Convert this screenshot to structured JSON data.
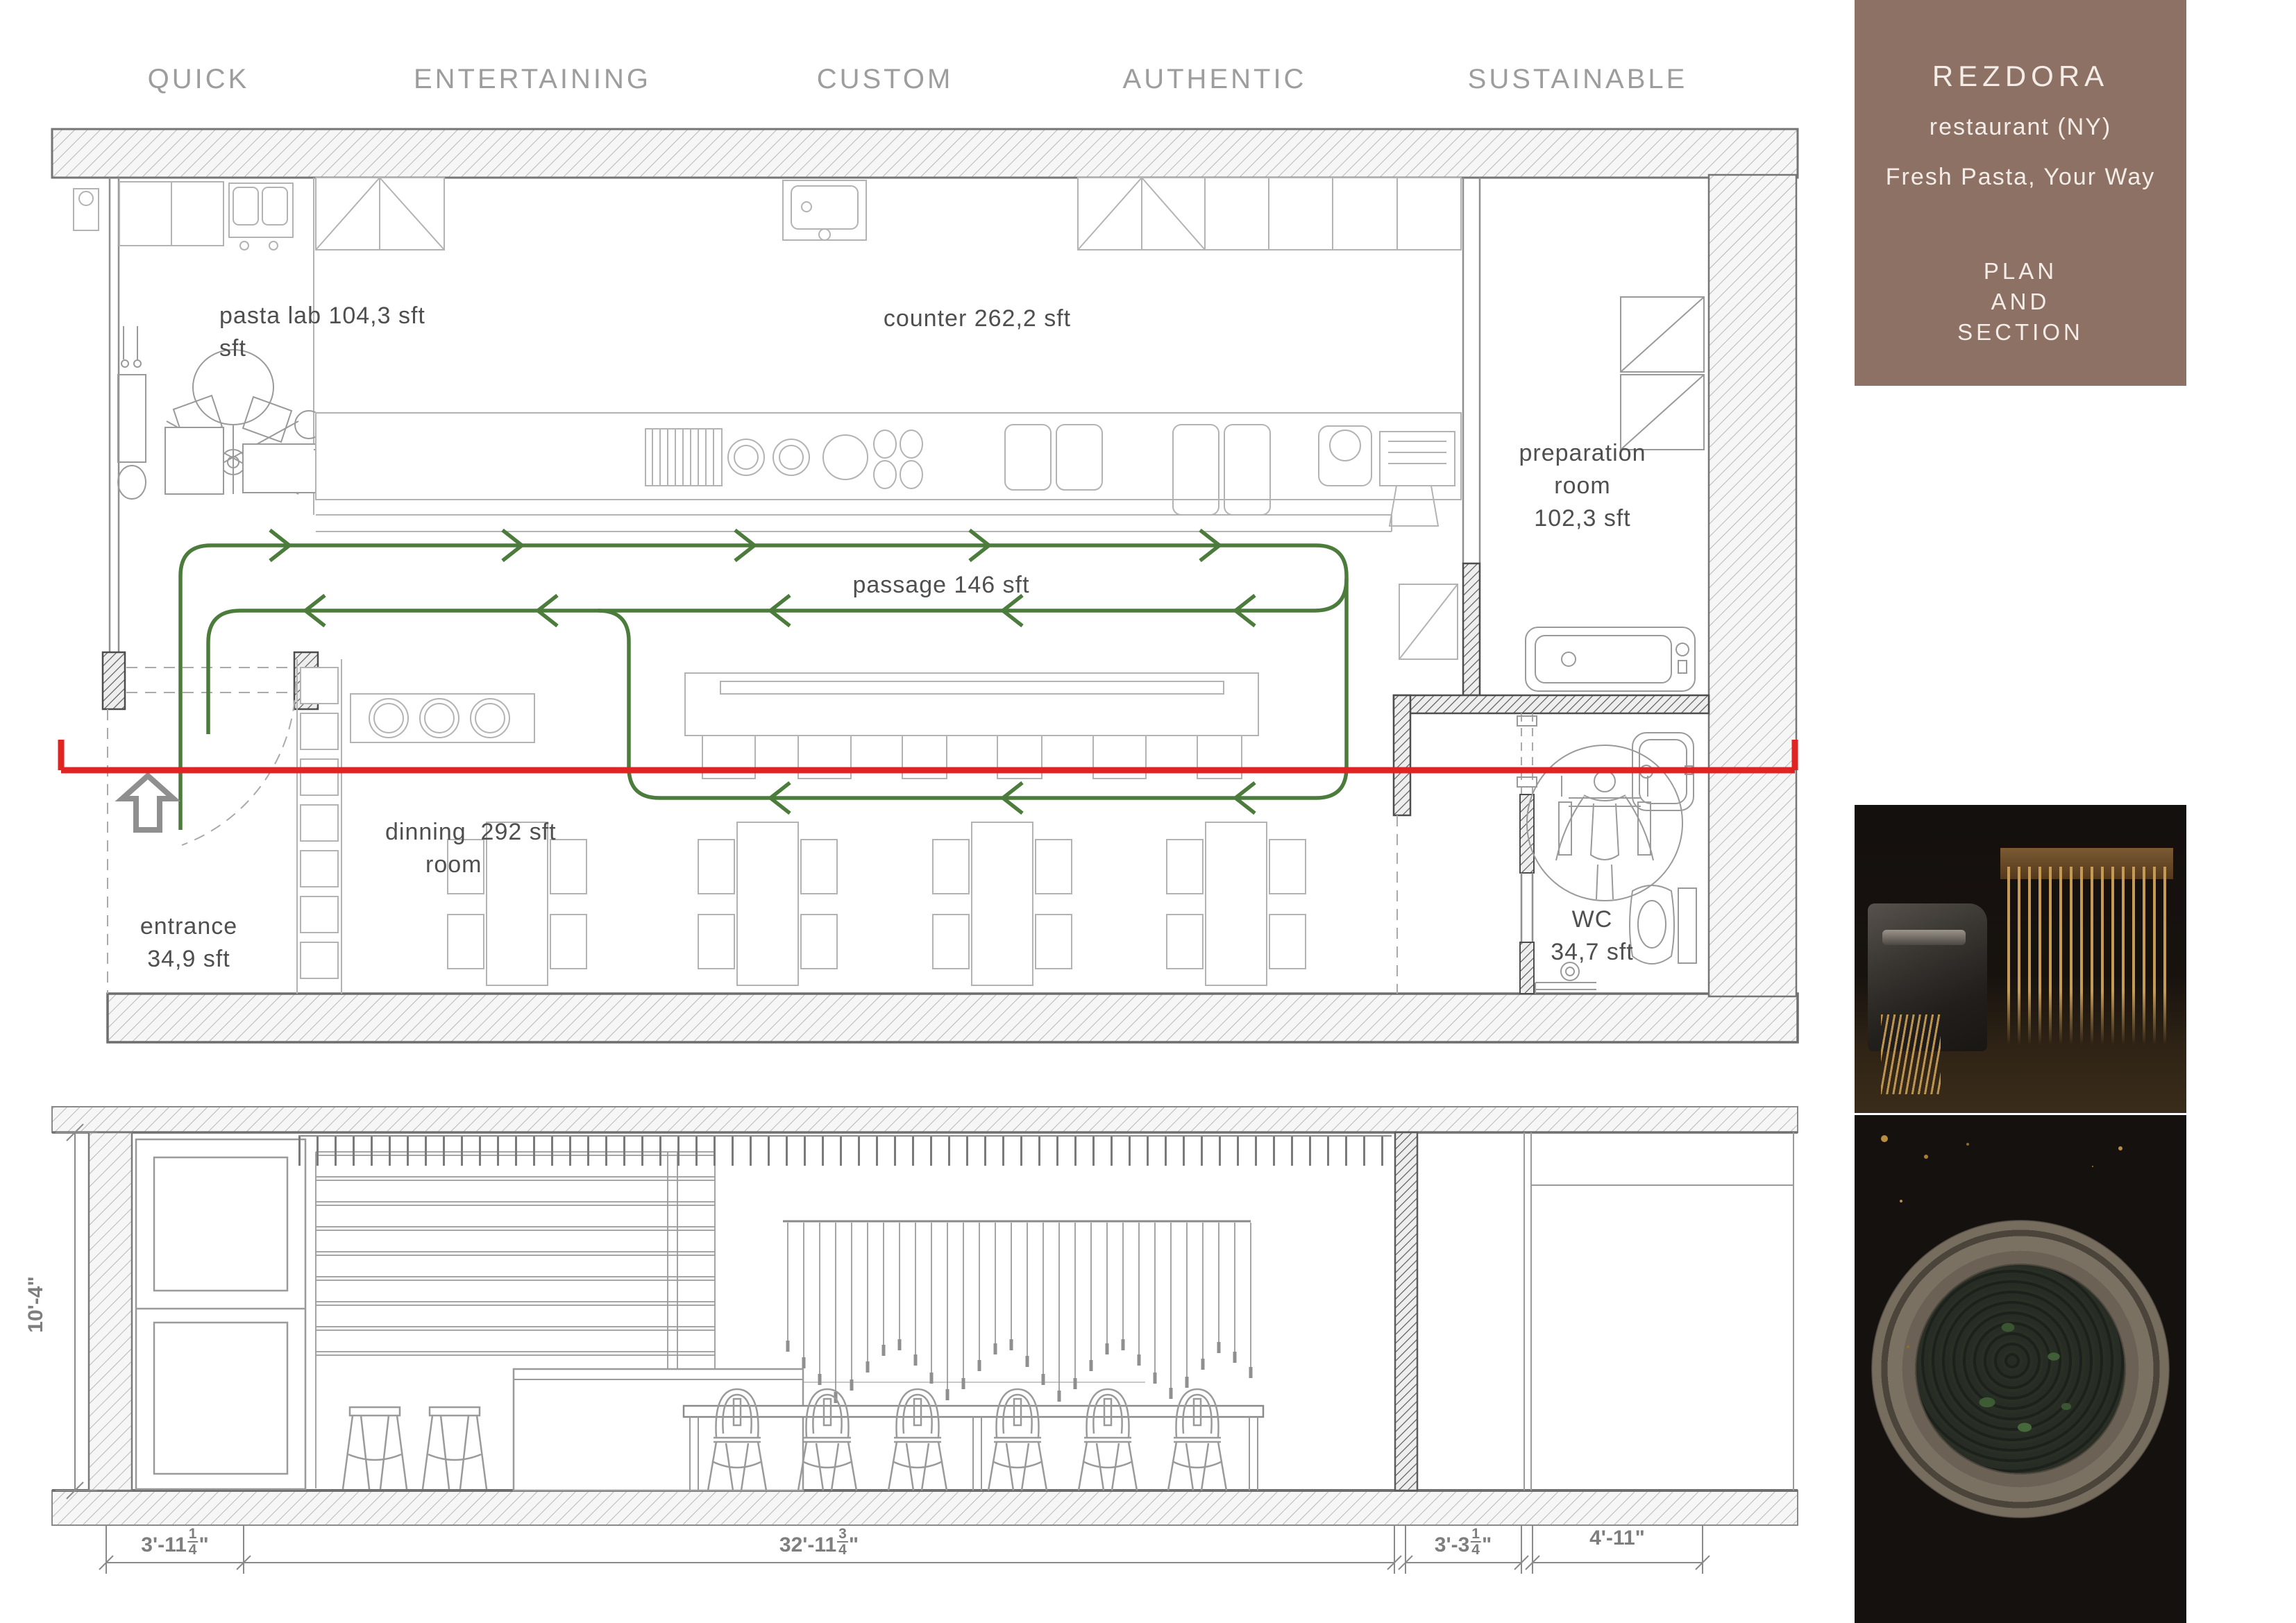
{
  "header": {
    "labels": [
      "QUICK",
      "ENTERTAINING",
      "CUSTOM",
      "AUTHENTIC",
      "SUSTAINABLE"
    ]
  },
  "sidebar": {
    "brand": "REZDORA",
    "subtitle": "restaurant (NY)",
    "tagline": "Fresh Pasta, Your Way",
    "sheet": [
      "PLAN",
      "AND",
      "SECTION"
    ],
    "panel_color": "#8c7164"
  },
  "plan": {
    "labels": {
      "pasta_lab": [
        "pasta lab 104,3 sft",
        "sft"
      ],
      "counter": "counter 262,2 sft",
      "preparation": [
        "preparation",
        "room",
        "102,3 sft"
      ],
      "passage": "passage 146 sft",
      "dinning": [
        "dinning  292 sft",
        "room"
      ],
      "entrance": [
        "entrance",
        "34,9 sft"
      ],
      "wc": [
        "WC",
        "34,7 sft"
      ]
    },
    "colors": {
      "circulation": "#4c7c3c",
      "section_cut": "#e02424"
    }
  },
  "section": {
    "height_dim": "10'-4\"",
    "dims": [
      {
        "pre": "3'-11",
        "num": "1",
        "den": "4",
        "post": "\""
      },
      {
        "pre": "32'-11",
        "num": "3",
        "den": "4",
        "post": "\""
      },
      {
        "pre": "3'-3",
        "num": "1",
        "den": "4",
        "post": "\""
      },
      {
        "pre": "4'-11",
        "num": "",
        "den": "",
        "post": "\""
      }
    ]
  }
}
